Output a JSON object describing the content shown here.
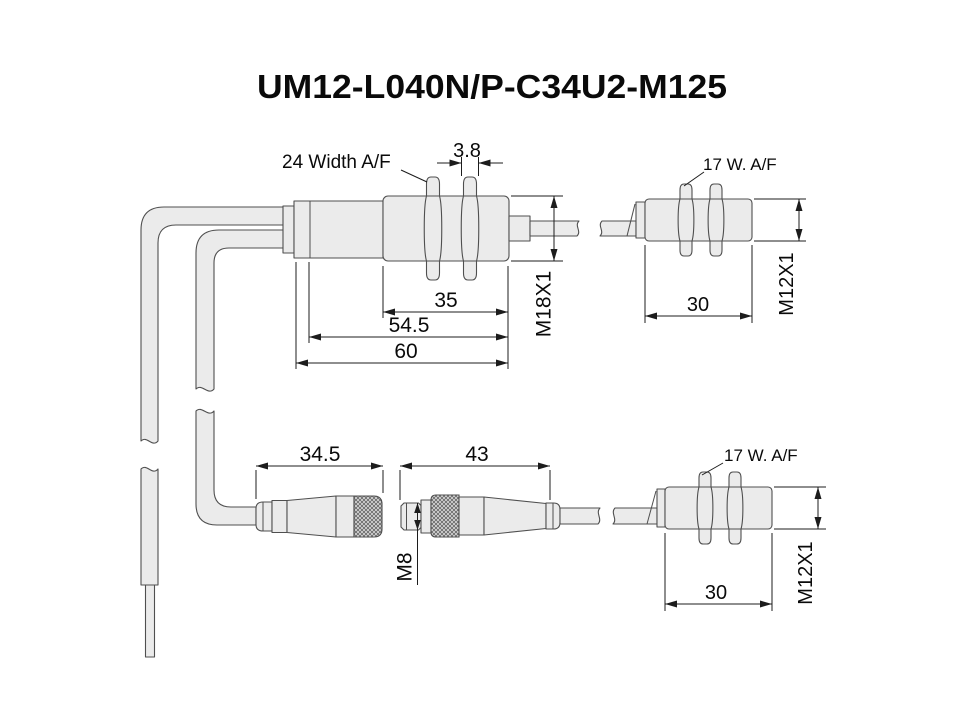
{
  "title": "UM12-L040N/P-C34U2-M125",
  "colors": {
    "background": "#ffffff",
    "part_fill": "#ebebeb",
    "part_outline": "#4f4f4f",
    "dimension_lines": "#1c1c1c",
    "text": "#0a0a0a"
  },
  "main_sensor": {
    "hex_nut_label": "24 Width A/F",
    "nut_thickness_mm": "3.8",
    "thread_length_mm": "35",
    "body_length_mm": "54.5",
    "total_length_mm": "60",
    "thread_spec": "M18X1"
  },
  "remote_sensor_top": {
    "hex_nut_label": "17 W. A/F",
    "body_length_mm": "30",
    "thread_spec": "M12X1"
  },
  "cable_connector_female": {
    "length_mm": "34.5"
  },
  "cable_connector_male": {
    "length_mm": "43",
    "thread_spec": "M8"
  },
  "remote_sensor_bottom": {
    "hex_nut_label": "17 W. A/F",
    "body_length_mm": "30",
    "thread_spec": "M12X1"
  }
}
